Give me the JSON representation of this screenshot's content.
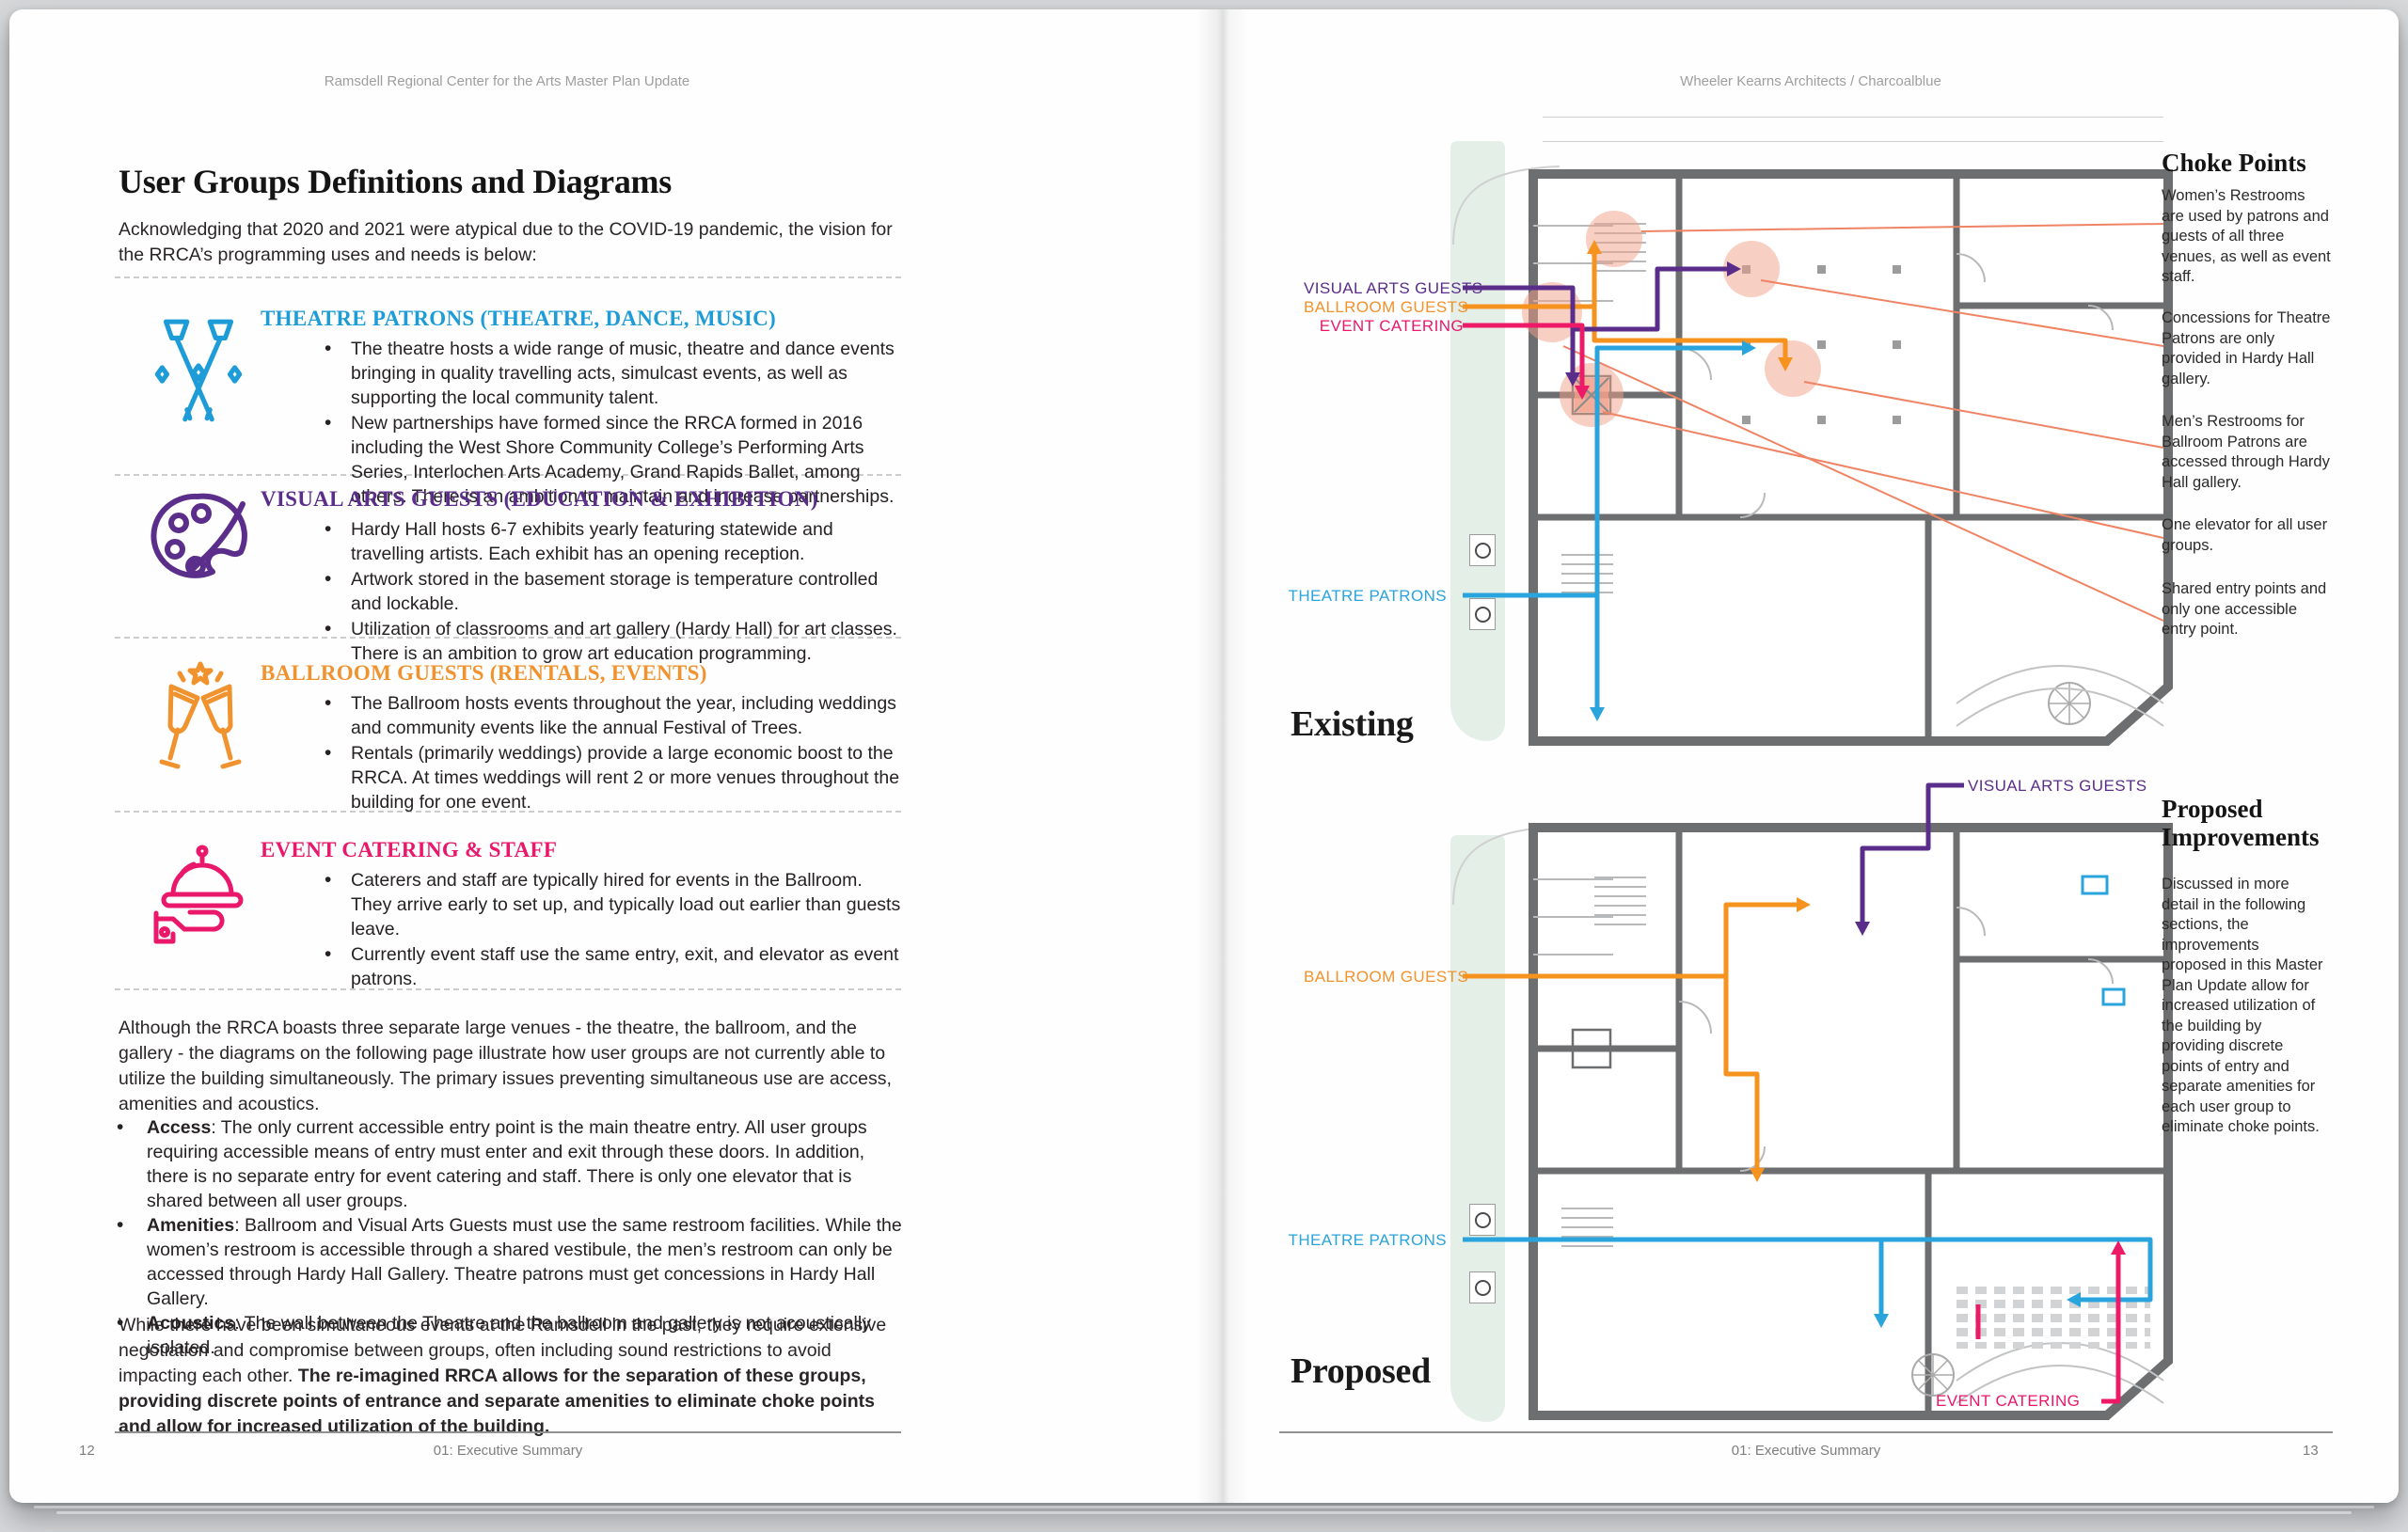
{
  "colors": {
    "blue": "#29a4dd",
    "purple": "#5b2d8a",
    "orange": "#f6921e",
    "pink": "#ec1a67",
    "salmon": "#f2a088",
    "leader": "#ef8465",
    "wall": "#6d6e70",
    "green_strip": "#e4efe8"
  },
  "left_page": {
    "header": "Ramsdell Regional Center for the Arts Master Plan Update",
    "title": "User Groups Definitions and Diagrams",
    "intro": "Acknowledging that 2020 and 2021 were atypical due to the COVID-19 pandemic, the vision for the RRCA’s programming uses and needs is below:",
    "groups": [
      {
        "heading": "THEATRE PATRONS (THEATRE, DANCE, MUSIC)",
        "color": "#1e9cd7",
        "icon": "spotlights-icon",
        "bullets": [
          "The theatre hosts a wide range of music, theatre and dance events bringing in quality travelling acts, simulcast events, as well as supporting the local community talent.",
          "New partnerships have formed since the RRCA formed in 2016 including the West Shore Community College’s Performing Arts Series, Interlochen Arts Academy, Grand Rapids Ballet, among others. There is an ambition to maintain and increase partnerships."
        ]
      },
      {
        "heading": "VISUAL ARTS GUESTS (EDUCATION & EXHIBITION)",
        "color": "#5c2e8b",
        "icon": "palette-icon",
        "bullets": [
          "Hardy Hall hosts 6-7 exhibits yearly featuring statewide and travelling artists. Each exhibit has an opening reception.",
          "Artwork stored in the basement storage is temperature controlled and lockable.",
          "Utilization of classrooms and art gallery (Hardy Hall) for art classes. There is an ambition to grow art education programming."
        ]
      },
      {
        "heading": "BALLROOM GUESTS (RENTALS, EVENTS)",
        "color": "#f0922d",
        "icon": "champagne-toast-icon",
        "bullets": [
          "The Ballroom hosts events throughout the year, including weddings and community events like the annual Festival of Trees.",
          "Rentals (primarily weddings) provide a large economic boost to the RRCA. At times weddings will rent 2 or more venues throughout the building for one event."
        ]
      },
      {
        "heading": "EVENT CATERING & STAFF",
        "color": "#e9186b",
        "icon": "catering-cloche-icon",
        "bullets": [
          "Caterers and staff are typically hired for events in the Ballroom. They arrive early to set up, and typically load out earlier than guests leave.",
          "Currently event staff use the same entry, exit, and elevator as event patrons."
        ]
      }
    ],
    "para1": "Although the RRCA boasts three separate large venues - the theatre, the ballroom, and the gallery - the diagrams on the following page illustrate how user groups are not currently able to utilize the building simultaneously. The primary issues preventing simultaneous use are access, amenities and acoustics.",
    "issues": [
      {
        "term": "Access",
        "text": ": The only current accessible entry point is the main theatre entry. All user groups requiring accessible means of entry must enter and exit through these doors. In addition, there is no separate entry for event catering and staff. There is only one elevator that is shared between all user groups."
      },
      {
        "term": "Amenities",
        "text": ": Ballroom and Visual Arts Guests must use the same restroom facilities. While the women’s restroom is accessible through a shared vestibule, the men’s restroom can only be accessed through Hardy Hall Gallery. Theatre patrons must get concessions in Hardy Hall Gallery."
      },
      {
        "term": "Acoustics",
        "text": ": The wall between the Theatre and the ballroom and gallery is not acoustically isolated."
      }
    ],
    "para2_normal": "While there have been simultaneous events at the Ramsdell in the past, they require extensive negotiation and compromise between groups, often including sound restrictions to avoid impacting each other. ",
    "para2_bold": "The re-imagined RRCA allows for the separation of these groups, providing discrete points of entrance and separate amenities to eliminate choke points and allow for increased utilization of the building.",
    "footer_page": "12",
    "footer_section": "01: Executive Summary"
  },
  "right_page": {
    "header": "Wheeler Kearns Architects / Charcoalblue",
    "existing": {
      "title": "Existing",
      "labels": {
        "visual_arts": "VISUAL ARTS GUESTS",
        "ballroom": "BALLROOM GUESTS",
        "event_catering": "EVENT CATERING",
        "theatre": "THEATRE PATRONS"
      }
    },
    "choke_points": {
      "heading": "Choke Points",
      "notes": [
        "Women’s Restrooms are used by patrons and guests of all three venues, as well as event staff.",
        "Concessions for Theatre Patrons are only provided in Hardy Hall gallery.",
        "Men’s Restrooms for Ballroom Patrons are accessed through Hardy Hall gallery.",
        "One elevator for all user groups.",
        "Shared entry points and only one accessible entry point."
      ]
    },
    "proposed": {
      "title": "Proposed",
      "labels": {
        "visual_arts": "VISUAL ARTS GUESTS",
        "ballroom": "BALLROOM GUESTS",
        "theatre": "THEATRE PATRONS",
        "event_catering": "EVENT CATERING"
      }
    },
    "improvements": {
      "heading_line1": "Proposed",
      "heading_line2": "Improvements",
      "body": "Discussed in more detail in the following sections, the improvements proposed in this Master Plan Update allow for increased utilization of the building by providing discrete points of entry and separate amenities for each user group to eliminate choke points."
    },
    "footer_section": "01: Executive Summary",
    "footer_page": "13"
  }
}
